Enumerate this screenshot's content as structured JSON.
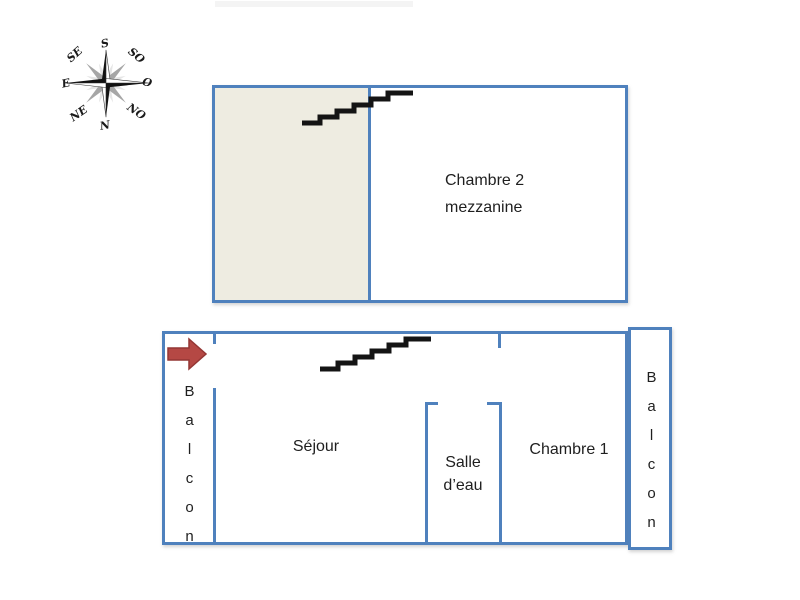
{
  "colors": {
    "wall": "#4f81bd",
    "beige": "#eeece1",
    "arrow_fill": "#b54844",
    "arrow_stroke": "#943634",
    "stairs": "#141414",
    "text": "#1f1f1f"
  },
  "compass": {
    "labels": {
      "s": "S",
      "so": "SO",
      "o": "O",
      "no": "NO",
      "n": "N",
      "ne": "NE",
      "e": "E",
      "se": "SE"
    }
  },
  "upper_floor": {
    "room_chambre2_line1": "Chambre 2",
    "room_chambre2_line2": "mezzanine"
  },
  "lower_floor": {
    "balcony_left": "Balcon",
    "balcony_right": "Balcon",
    "living_room": "Séjour",
    "bathroom_line1": "Salle",
    "bathroom_line2": "d’eau",
    "bedroom": "Chambre 1"
  }
}
